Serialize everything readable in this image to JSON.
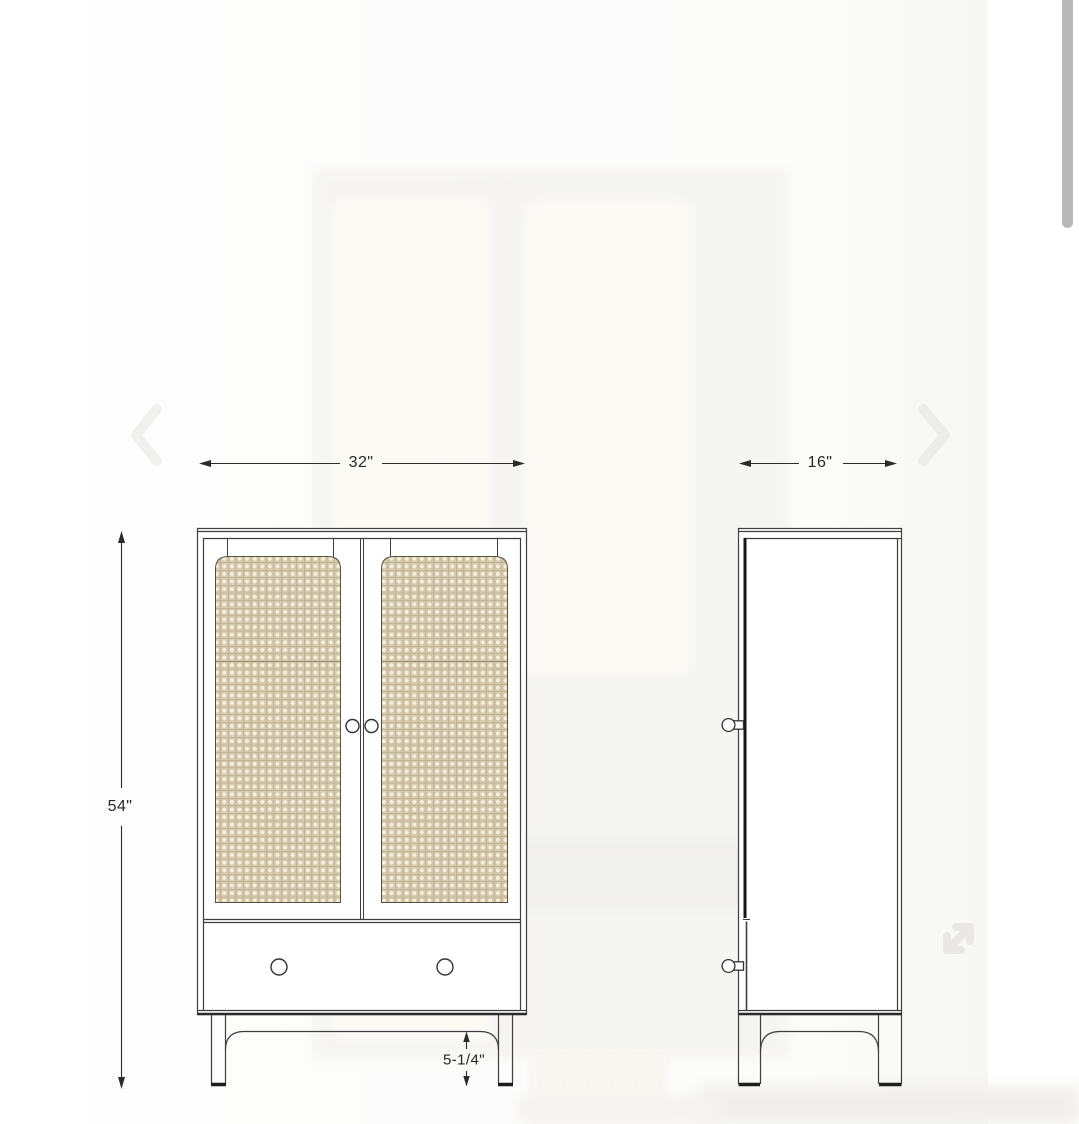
{
  "viewer": {
    "content_description": "Cabinet dimension diagram, front and side views",
    "scrollbar_color": "#b9b9b9"
  },
  "carousel": {
    "prev_icon": "chevron-left-icon",
    "next_icon": "chevron-right-icon",
    "expand_icon": "expand-arrows-icon"
  },
  "dimensions": {
    "width": "32\"",
    "depth": "16\"",
    "height": "54\"",
    "leg_height": "5-1/4\""
  },
  "diagram_colors": {
    "outline": "#3e3e3e",
    "dimension_line": "#2b2b2b",
    "cane_base": "#d8ccb0",
    "cane_dot": "#f6efda",
    "cane_grid": "#aa9d82"
  }
}
